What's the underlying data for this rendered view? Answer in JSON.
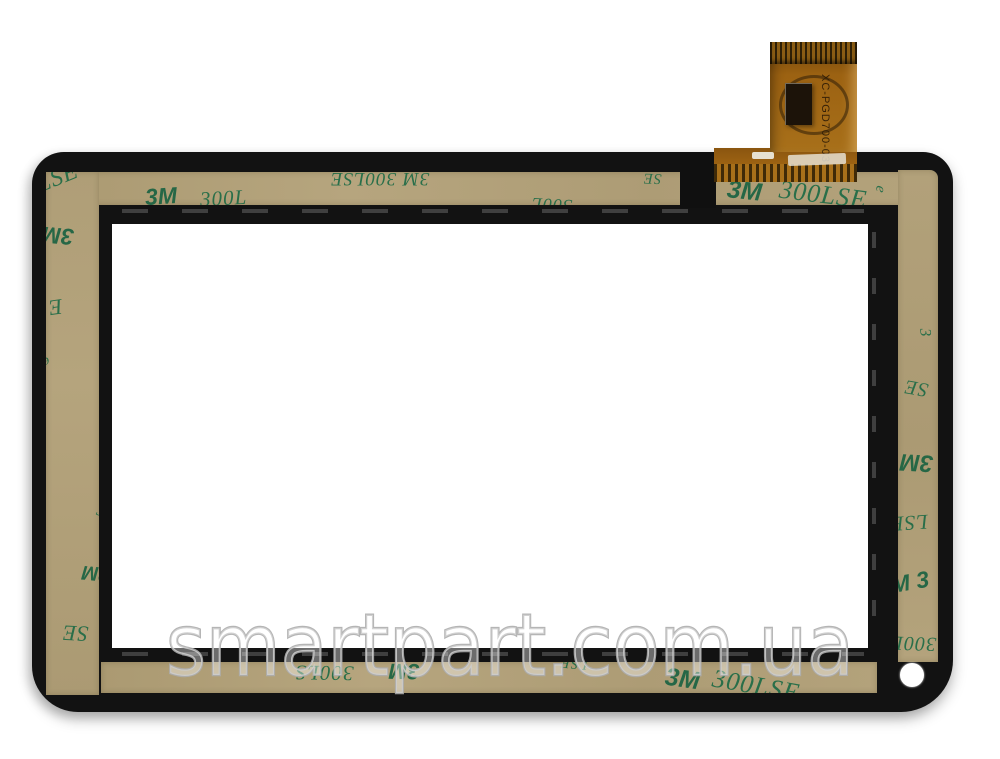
{
  "watermark": {
    "text": "smartpart.com.ua"
  },
  "flex_cable": {
    "label": "XC-PGD700-03"
  },
  "tape": {
    "brand_text": "3M 300LSE"
  },
  "colors": {
    "background": "#ffffff",
    "frame_black": "#121212",
    "tape_tan": "#b1a078",
    "tape_print_green": "#1e6b46",
    "flex_orange": "#9c6212",
    "watermark_gray": "#adadad"
  },
  "tape_prints": [
    {
      "text": "3M",
      "strip": "top",
      "x": 97,
      "y": 13,
      "size": 23,
      "rot": -4,
      "bold": true
    },
    {
      "text": "300L",
      "strip": "top",
      "x": 152,
      "y": 16,
      "size": 21,
      "rot": -3,
      "italic": true
    },
    {
      "text": "3M 300LSE",
      "strip": "top",
      "x": 282,
      "y": -3,
      "size": 19,
      "rot": 180,
      "italic": true
    },
    {
      "text": "300L",
      "strip": "top",
      "x": 483,
      "y": 24,
      "size": 18,
      "rot": 183,
      "italic": true
    },
    {
      "text": "SE",
      "strip": "top",
      "x": 595,
      "y": -2,
      "size": 15,
      "rot": 182,
      "italic": true
    },
    {
      "text": "3M",
      "strip": "top",
      "x": 679,
      "y": 7,
      "size": 25,
      "rot": 6,
      "bold": true
    },
    {
      "text": "300LSE",
      "strip": "top",
      "x": 731,
      "y": 10,
      "size": 26,
      "rot": 7,
      "italic": true
    },
    {
      "text": "LSE",
      "strip": "left",
      "x": -10,
      "y": -6,
      "size": 24,
      "rot": -22,
      "italic": true
    },
    {
      "text": "3M",
      "strip": "left",
      "x": -4,
      "y": 52,
      "size": 23,
      "rot": 185,
      "bold": true
    },
    {
      "text": "E",
      "strip": "left",
      "x": 2,
      "y": 124,
      "size": 22,
      "rot": 172,
      "italic": true
    },
    {
      "text": "e",
      "strip": "left",
      "x": -4,
      "y": 182,
      "size": 14,
      "rot": 160,
      "italic": true
    },
    {
      "text": "3",
      "strip": "left",
      "x": 51,
      "y": 330,
      "size": 17,
      "rot": 15,
      "italic": true
    },
    {
      "text": "3M",
      "strip": "left",
      "x": 36,
      "y": 391,
      "size": 20,
      "rot": 185,
      "bold": true
    },
    {
      "text": "SE",
      "strip": "left",
      "x": 16,
      "y": 450,
      "size": 22,
      "rot": 183,
      "italic": true
    },
    {
      "text": "300LS",
      "strip": "bottom",
      "x": 194,
      "y": 0,
      "size": 21,
      "rot": 181,
      "italic": true
    },
    {
      "text": "3M",
      "strip": "bottom",
      "x": 288,
      "y": -2,
      "size": 22,
      "rot": 181,
      "bold": true
    },
    {
      "text": "LSE",
      "strip": "bottom",
      "x": 459,
      "y": -7,
      "size": 15,
      "rot": 185,
      "italic": true
    },
    {
      "text": "3M",
      "strip": "bottom",
      "x": 564,
      "y": 5,
      "size": 25,
      "rot": 8,
      "bold": true
    },
    {
      "text": "300LSE",
      "strip": "bottom",
      "x": 611,
      "y": 11,
      "size": 26,
      "rot": 10,
      "italic": true
    },
    {
      "text": "e",
      "strip": "stage",
      "x": 876,
      "y": 182,
      "size": 15,
      "rot": 100,
      "italic": true
    },
    {
      "text": "3",
      "strip": "right",
      "x": 22,
      "y": 155,
      "size": 16,
      "rot": 85,
      "italic": true
    },
    {
      "text": "SE",
      "strip": "right",
      "x": 6,
      "y": 208,
      "size": 20,
      "rot": 190,
      "italic": true
    },
    {
      "text": "3M",
      "strip": "right",
      "x": 2,
      "y": 280,
      "size": 24,
      "rot": 183,
      "bold": true
    },
    {
      "text": "LSE",
      "strip": "right",
      "x": -8,
      "y": 342,
      "size": 21,
      "rot": 176,
      "italic": true
    },
    {
      "text": "3M 3",
      "strip": "right",
      "x": -20,
      "y": 402,
      "size": 23,
      "rot": -10,
      "bold": true
    },
    {
      "text": "300LS",
      "strip": "right",
      "x": -18,
      "y": 463,
      "size": 20,
      "rot": 182,
      "italic": true
    }
  ]
}
